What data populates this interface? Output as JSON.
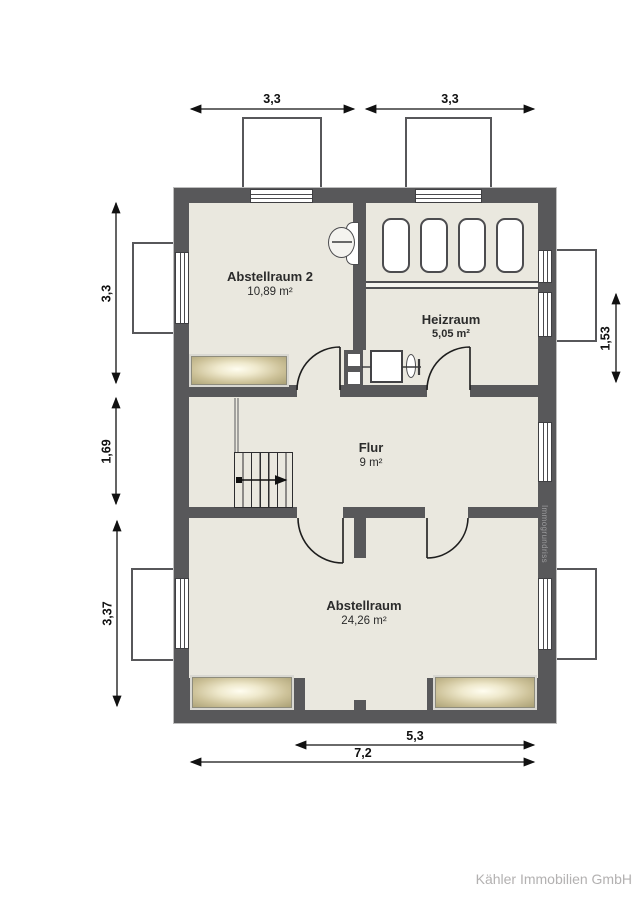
{
  "meta": {
    "footer": "Kähler Immobilien GmbH",
    "watermark": "Immogrundriss"
  },
  "rooms": [
    {
      "id": "abstellraum2",
      "name": "Abstellraum 2",
      "area": "10,89 m²"
    },
    {
      "id": "heizraum",
      "name": "Heizraum",
      "area": "5,05  m²"
    },
    {
      "id": "flur",
      "name": "Flur",
      "area": "9 m²"
    },
    {
      "id": "abstellraum",
      "name": "Abstellraum",
      "area": "24,26 m²"
    }
  ],
  "dimensions": {
    "top_left": "3,3",
    "top_right": "3,3",
    "left_top": "3,3",
    "left_middle": "1,69",
    "left_bottom": "3,37",
    "right_middle": "1,53",
    "bottom_inner": "5,3",
    "bottom_outer": "7,2"
  },
  "colors": {
    "wall": "#58585a",
    "floor": "#eae8df",
    "skylight": "#bdb189",
    "dimension_text": "#111111",
    "footer_text": "#b3b1b1"
  }
}
